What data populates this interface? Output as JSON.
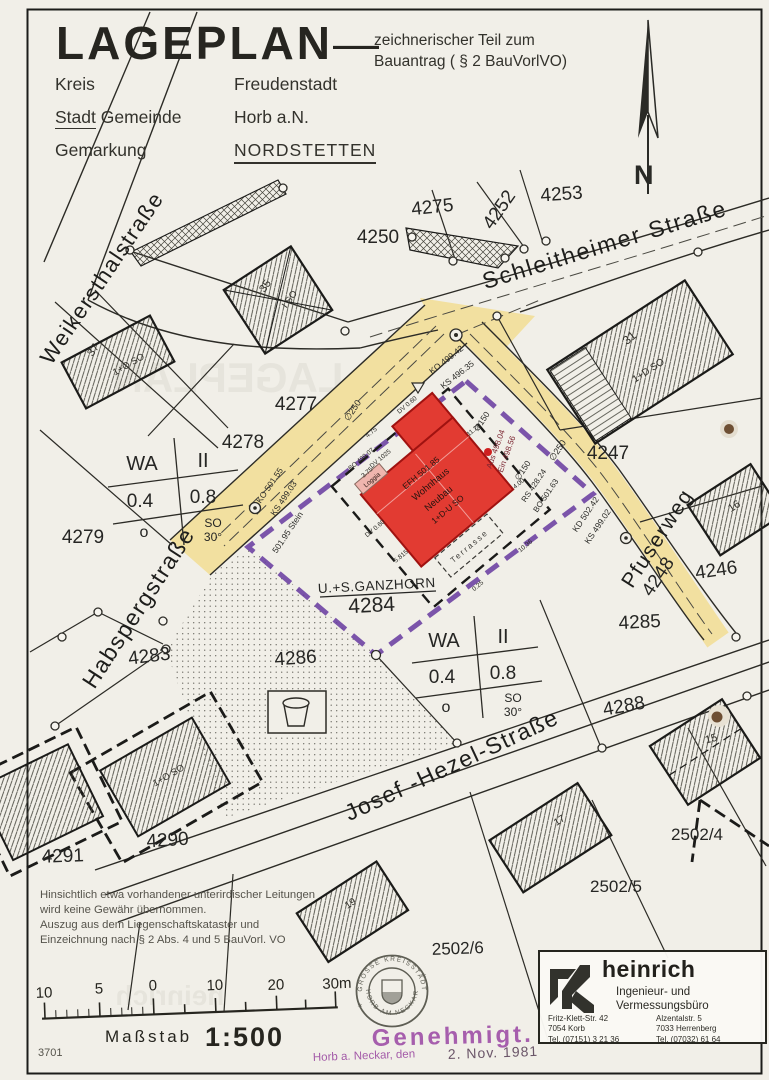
{
  "header": {
    "title": "LAGEPLAN",
    "dash": "—",
    "subtitle1": "zeichnerischer Teil zum",
    "subtitle2": "Bauantrag ( § 2 BauVorlVO)",
    "kreis_label": "Kreis",
    "kreis_value": "Freudenstadt",
    "stadt_label": "Stadt",
    "stadt_label2": "Gemeinde",
    "stadt_value": "Horb a.N.",
    "gemarkung_label": "Gemarkung",
    "gemarkung_value": "NORDSTETTEN",
    "north": "N"
  },
  "streets": {
    "weikersthal": "Weikersthalstraße",
    "schleitheimer": "Schleitheimer Straße",
    "habsperg": "Habspergstraße",
    "pfuserweg": "Pfuserweg",
    "josef_hezel": "Josef -Hezel-Straße"
  },
  "parcels": {
    "p4275": "4275",
    "p4252": "4252",
    "p4253": "4253",
    "p4250": "4250",
    "p4277": "4277",
    "p4278": "4278",
    "p4279": "4279",
    "p4283": "4283",
    "p4284": "4284",
    "p4285": "4285",
    "p4286": "4286",
    "p4288": "4288",
    "p4290": "4290",
    "p4291": "4291",
    "p4246": "4246",
    "p4247": "4247",
    "p4248": "4248",
    "p2502_4": "2502/4",
    "p2502_5": "2502/5",
    "p2502_6": "2502/6"
  },
  "buildings": {
    "b37": "37",
    "b37_note": "1+O SO",
    "b35": "35",
    "b35_note": "I SO",
    "b31": "31",
    "b31_note": "1+D SO",
    "b16": "16",
    "b15": "15",
    "b17": "17",
    "b19": "19",
    "b4290_note": "1+O SO"
  },
  "site": {
    "owner": "U.+S.GANZHORN",
    "parcel": "4284",
    "efh": "EFH 501.85",
    "line1": "Wohnhaus",
    "line2": "Neubau",
    "line3": "1+D-U SO",
    "loggia": "Loggia",
    "terrasse": "Terrasse"
  },
  "wa": {
    "use": "WA",
    "floors": "II",
    "grz": "0.4",
    "gfz": "0.8",
    "o": "o",
    "so": "SO",
    "deg": "30°"
  },
  "survey": {
    "ko1": "KO 499.42",
    "ks1": "KS 496.35",
    "ko2": "KO 501.55",
    "ks2": "KS 499.03",
    "stein": "501.95 Stein",
    "kd1": "KD 502.42",
    "ks3": "KS 499.02",
    "bo1": "BO 501.63",
    "rs1": "RS 428.24",
    "aus": "Aus 498.04",
    "ein": "Ein 498.56",
    "d250": "∅250",
    "d150": "∅150",
    "dv060": "DV 0.60",
    "bo2": "BO 499.07",
    "dv1025": "DV 1025",
    "dim_375": "3.75",
    "dim_475": "4.75",
    "dim_1125": "11.25",
    "dim_400": "4.00",
    "dim_1036": "10.36",
    "dim_025": "0.25",
    "dim_5815": "5.815"
  },
  "notes": {
    "l1": "Hinsichtlich etwa vorhandener unterirdischer Leitungen",
    "l2": "wird keine Gewähr übernommen.",
    "l3": "Auszug aus dem Liegenschaftskataster und",
    "l4": "Einzeichnung nach § 2 Abs. 4 und 5 BauVorl. VO"
  },
  "scale": {
    "n10a": "10",
    "n5": "5",
    "n0": "0",
    "n10b": "10",
    "n20": "20",
    "n30": "30m",
    "masstab": "Maßstab",
    "ratio": "1:500",
    "sheet": "3701"
  },
  "stamp": {
    "top": "GROSSE KREISSTADT",
    "bottom": "HORB AM NECKAR",
    "approved": "Genehmigt.",
    "place": "Horb a. Neckar, den",
    "date": "2. Nov. 1981"
  },
  "firm": {
    "name": "heinrich",
    "role1": "Ingenieur- und",
    "role2": "Vermessungsbüro",
    "a1": "Fritz-Klett-Str. 42",
    "a2": "7054 Korb",
    "a3": "Tel. (07151) 3 21 36",
    "b1": "Alzentalstr. 5",
    "b2": "7033 Herrenberg",
    "b3": "Tel. (07032) 61 64"
  },
  "colors": {
    "road_yellow": "#f2e0a0",
    "boundary_purple": "#6a3fa0",
    "new_building_red": "#e23b32",
    "stamp_purple": "#a052a8",
    "paper": "#f1efe8"
  }
}
